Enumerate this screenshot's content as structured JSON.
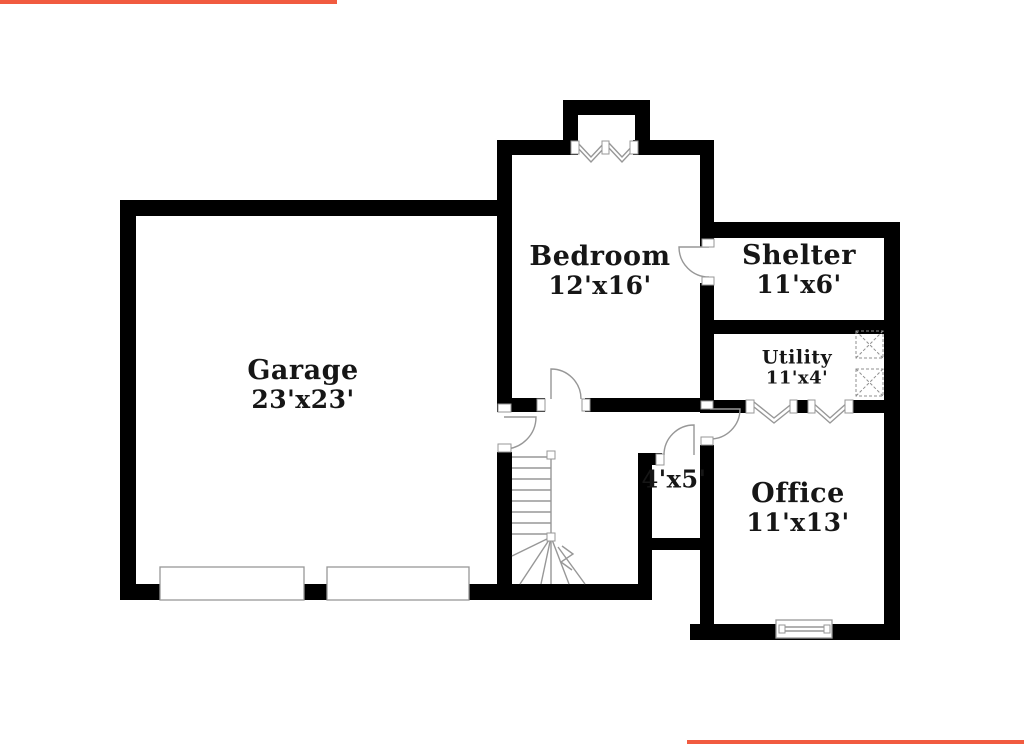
{
  "meta": {
    "title": "Basement floor plan",
    "accent_color": "#f15b40",
    "wall_color": "#000000",
    "background_color": "#ffffff",
    "line_color": "#979797"
  },
  "rooms": [
    {
      "id": "garage",
      "name": "Garage",
      "dims": "23'x23'"
    },
    {
      "id": "bedroom",
      "name": "Bedroom",
      "dims": "12'x16'"
    },
    {
      "id": "shelter",
      "name": "Shelter",
      "dims": "11'x6'"
    },
    {
      "id": "utility",
      "name": "Utility",
      "dims": "11'x4'"
    },
    {
      "id": "office",
      "name": "Office",
      "dims": "11'x13'"
    },
    {
      "id": "closet",
      "name": "",
      "dims": "4'x5'"
    }
  ]
}
